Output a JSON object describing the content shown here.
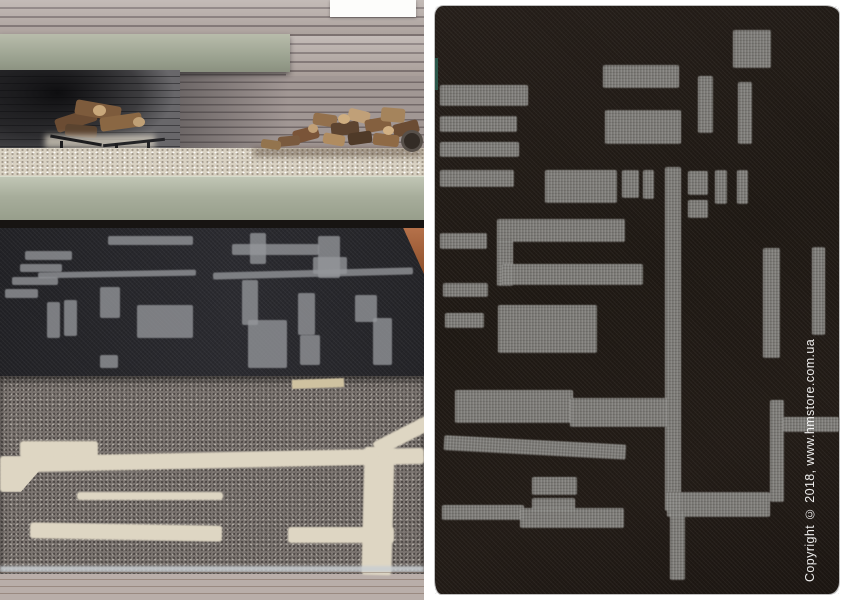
{
  "gallery": {
    "left_photo": {
      "alt": "Interior photo: concrete and brick fireplace with a stack of firewood, a dark patterned rug and a grey rug with cream lines layered on a wooden floor"
    },
    "right_photo": {
      "alt": "Product photo: dark charcoal felt rug with light grey geometric block and bar pattern on a white background",
      "watermark": "Copyright © 2018, www.hmstore.com.ua"
    }
  },
  "colors": {
    "canvas_bg": "#ffffff",
    "brick": "#b3a8a3",
    "mortar": "#8f8687",
    "beam": "#a9ae9d",
    "firebox": "#68676a",
    "pebble": "#d8d1c2",
    "hearth": "#abb1a0",
    "rug_dark_left": "#26262b",
    "rug_pattern_left": "#95979b",
    "rug_gray": "#7b7470",
    "rug_cream": "#ded6c3",
    "wood_floor": "#a05a2d",
    "rug_right_bg": "#221c18",
    "rug_right_pattern": "#8e8d89",
    "watermark_color": "#ffffff"
  }
}
